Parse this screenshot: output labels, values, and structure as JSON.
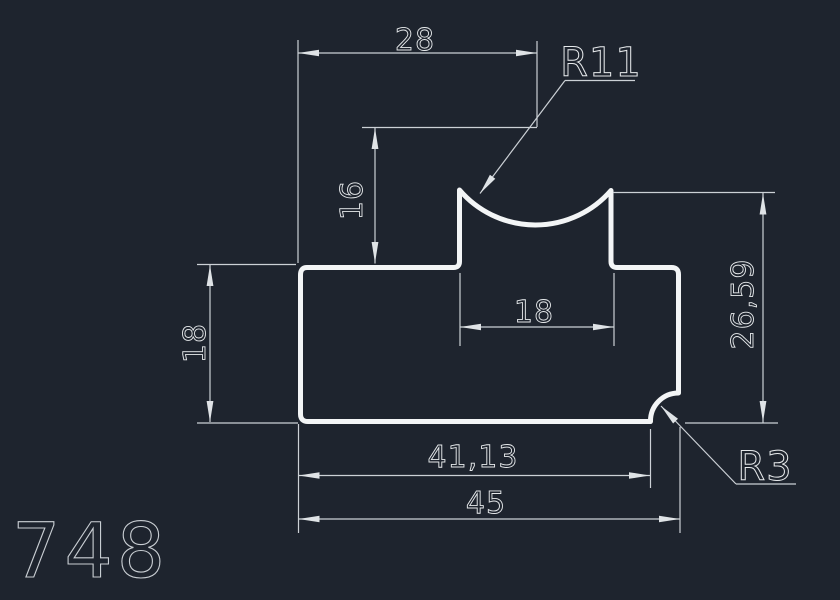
{
  "canvas": {
    "background": "#1e242e",
    "geometry_color": "#f3f5f6",
    "dimension_color": "#ccd1d6",
    "text_color": "#e6e9eb"
  },
  "drawing_number": "748",
  "dimensions": {
    "top_width": "28",
    "notch_radius": "R11",
    "notch_center_height": "16",
    "left_height": "18",
    "boss_width": "18",
    "right_height": "26,59",
    "bottom_to_fillet": "41,13",
    "overall_width": "45",
    "corner_radius": "R3"
  }
}
